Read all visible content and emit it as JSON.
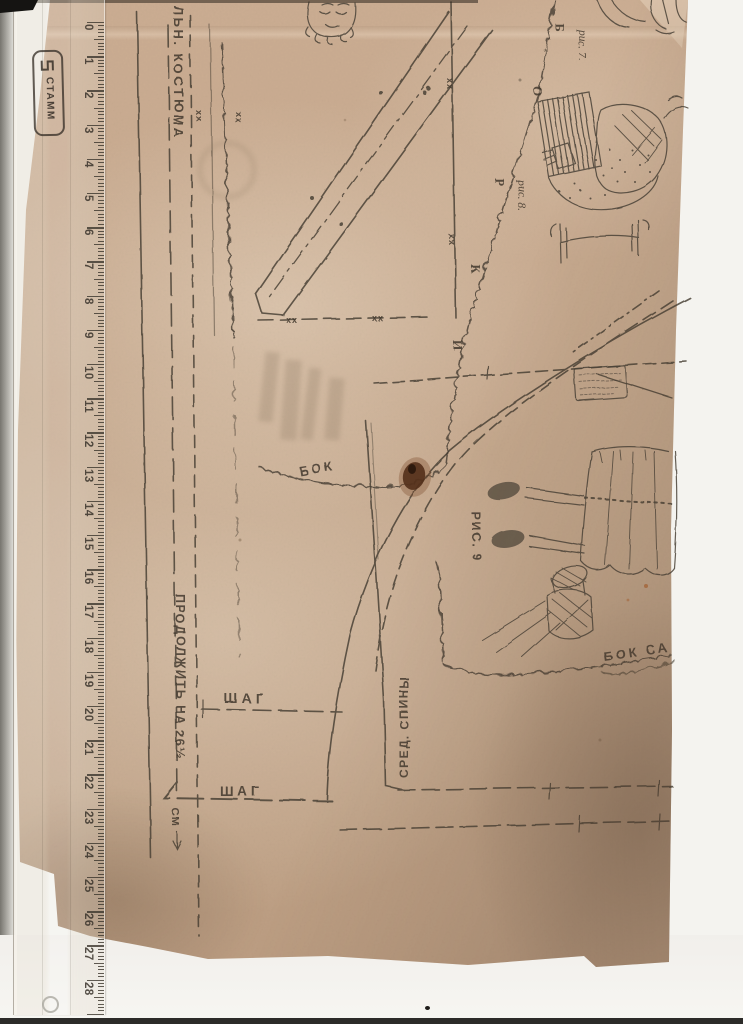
{
  "ruler": {
    "brand": "СТАММ",
    "numbers": [
      0,
      1,
      2,
      3,
      4,
      5,
      6,
      7,
      8,
      9,
      10,
      11,
      12,
      13,
      14,
      15,
      16,
      17,
      18,
      19,
      20,
      21,
      22,
      23,
      24,
      25,
      26,
      27,
      28
    ]
  },
  "pattern": {
    "labels": {
      "garment_title_fragment": "ЛЬН. КОСТЮМА",
      "fig7": "рис. 7.",
      "fig8": "рис. 8.",
      "fig9": "РИС. 9",
      "bok": "БОК",
      "bok_sarafana_fragment": "БОК СА",
      "sred_spiny": "СРЕД. СПИНЫ",
      "shag": "ШАГ",
      "prodolzhit": "ПРОДОЛЖИТЬ НА 26½",
      "cm": "СМ"
    },
    "point_letters": [
      "Б",
      "О",
      "Р",
      "К",
      "И"
    ],
    "marks": {
      "xx": "хх"
    }
  },
  "colors": {
    "paper": "#c6a88d",
    "ink": "#42392e",
    "background": "#f5f4f0",
    "stain": "#5f3d24"
  }
}
